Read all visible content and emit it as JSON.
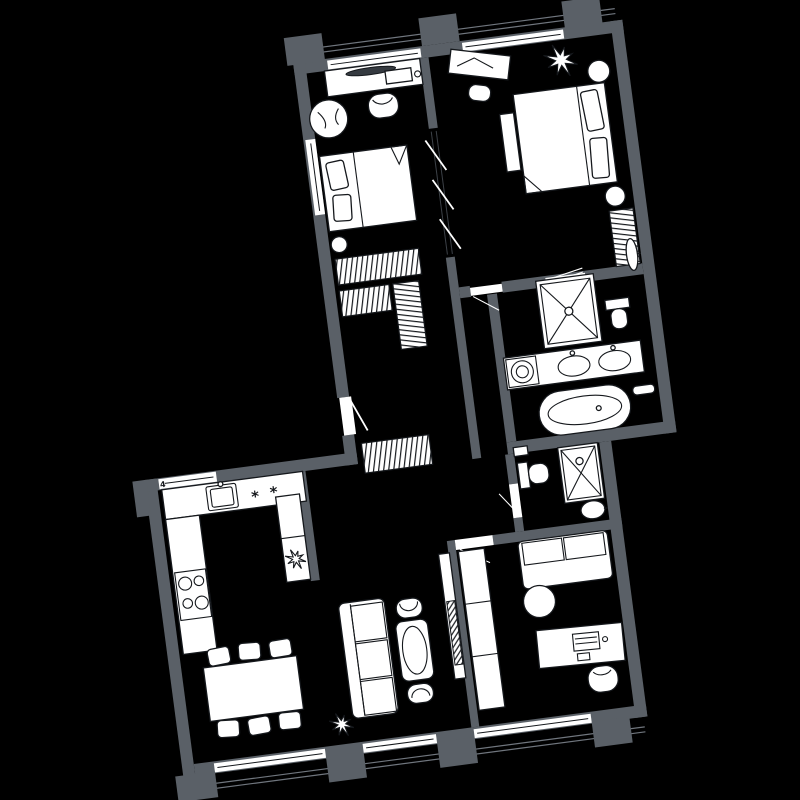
{
  "palette": {
    "background": "#000000",
    "wall": "#5a6067",
    "furniture_fill": "#ffffff",
    "line": "#15181c",
    "glass_line": "#70767e"
  },
  "plan": {
    "type": "apartment-floor-plan",
    "rotation_deg": -7.5,
    "labels": {
      "window_number": "4"
    },
    "cooktop_mark": "*",
    "rooms": [
      {
        "name": "bedroom-1",
        "furniture": [
          "vanity-table",
          "vanity-mirror",
          "drawer-box",
          "tub-chair",
          "armchair",
          "bed-with-pillows",
          "round-stool",
          "window"
        ]
      },
      {
        "name": "bedroom-2",
        "furniture": [
          "desk",
          "desk-chair",
          "plant",
          "round-nightstand",
          "round-nightstand",
          "double-bed-with-pillows",
          "bedside-bench",
          "radiator",
          "window"
        ]
      },
      {
        "name": "walk-in-closet-hall",
        "furniture": [
          "hatched-wardrobe",
          "hatched-wardrobe",
          "hatched-wardrobe-vertical",
          "hatched-wardrobe",
          "sliding-door",
          "entrance-door"
        ]
      },
      {
        "name": "bathroom",
        "furniture": [
          "shower-cabin",
          "toilet",
          "wall-mirror",
          "double-vanity-with-sinks",
          "washing-machine",
          "freestanding-bathtub",
          "towel-rail",
          "door-leaf"
        ]
      },
      {
        "name": "shower-wc",
        "furniture": [
          "boiler-shelf",
          "toilet",
          "shower-cabin",
          "sink",
          "door"
        ]
      },
      {
        "name": "office",
        "furniture": [
          "built-in-wardrobe",
          "two-seat-sofa",
          "round-side-table",
          "desk-with-laptop",
          "desk-chair",
          "window",
          "door"
        ]
      },
      {
        "name": "living-room",
        "furniture": [
          "three-seat-sofa",
          "oval-table",
          "tub-chair",
          "tub-chair",
          "tv-console",
          "tv",
          "plant",
          "window"
        ]
      },
      {
        "name": "kitchen-dining",
        "furniture": [
          "counter-with-sink",
          "cooktop-two-marks",
          "stove-four-rings",
          "tall-cabinet",
          "plant",
          "dining-table",
          "six-chairs",
          "window-with-number"
        ]
      }
    ]
  }
}
